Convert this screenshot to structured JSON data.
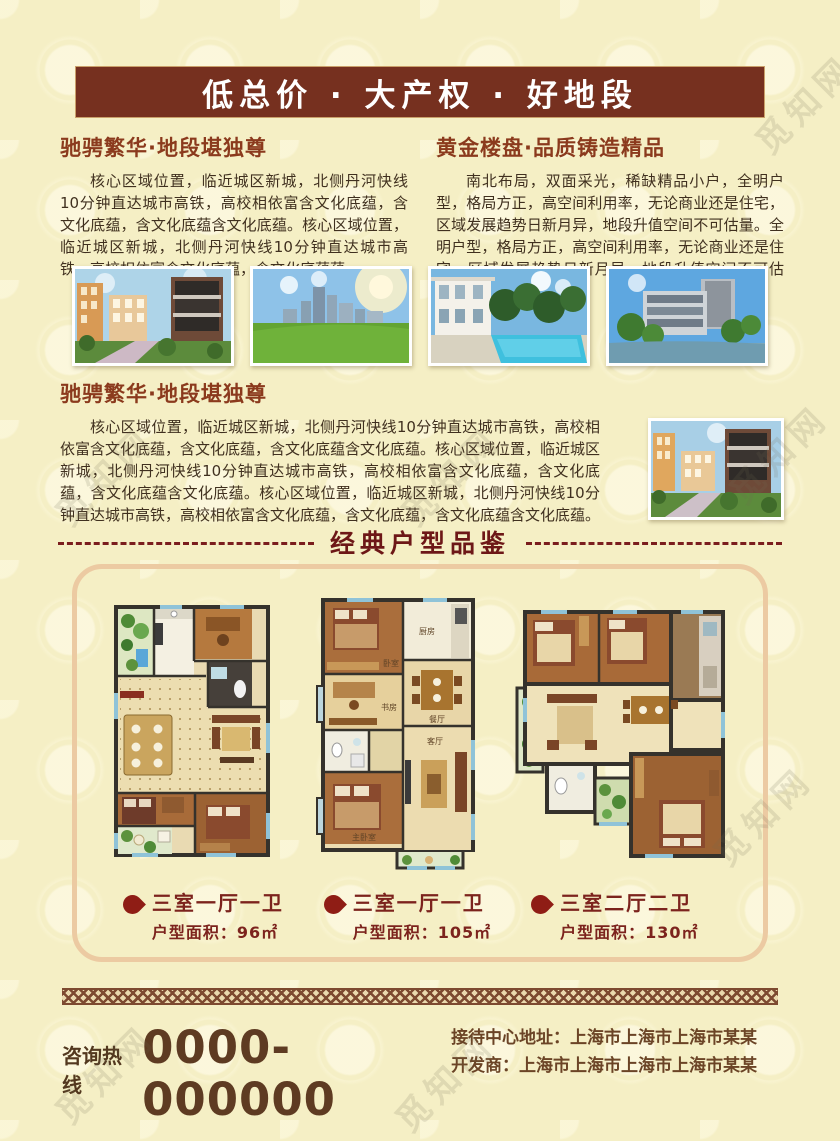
{
  "banner": {
    "title": "低总价 · 大产权 · 好地段"
  },
  "intro_left": {
    "heading": "驰骋繁华·地段堪独尊",
    "body": "核心区域位置，临近城区新城，北侧丹河快线10分钟直达城市高铁，高校相依富含文化底蕴，含文化底蕴，含文化底蕴含文化底蕴。核心区域位置，临近城区新城，北侧丹河快线10分钟直达城市高铁，高校相依富含文化底蕴，含文化底蕴蕴。"
  },
  "intro_right": {
    "heading": "黄金楼盘·品质铸造精品",
    "body": "南北布局，双面采光，稀缺精品小户，全明户型，格局方正，高空间利用率，无论商业还是住宅，区域发展趋势日新月异，地段升值空间不可估量。全明户型，格局方正，高空间利用率，无论商业还是住宅，区域发展趋势日新月异，地段升值空间不可估量。"
  },
  "photos": [
    {
      "name": "residential-courtyard-photo"
    },
    {
      "name": "city-skyline-lawn-photo"
    },
    {
      "name": "villa-pool-photo"
    },
    {
      "name": "office-waterfront-photo"
    }
  ],
  "section2": {
    "heading": "驰骋繁华·地段堪独尊",
    "body": "核心区域位置，临近城区新城，北侧丹河快线10分钟直达城市高铁，高校相依富含文化底蕴，含文化底蕴，含文化底蕴含文化底蕴。核心区域位置，临近城区新城，北侧丹河快线10分钟直达城市高铁，高校相依富含文化底蕴，含文化底蕴，含文化底蕴含文化底蕴。核心区域位置，临近城区新城，北侧丹河快线10分钟直达城市高铁，高校相依富含文化底蕴，含文化底蕴，含文化底蕴含文化底蕴。",
    "photo": "residential-courtyard-photo-2"
  },
  "divider": {
    "title": "经典户型品鉴"
  },
  "floor_plans": [
    {
      "type": "三室一厅一卫",
      "area": "户型面积：96㎡"
    },
    {
      "type": "三室一厅一卫",
      "area": "户型面积：105㎡"
    },
    {
      "type": "三室二厅二卫",
      "area": "户型面积：130㎡"
    }
  ],
  "plan2_rooms": {
    "bedroom": "卧室",
    "kitchen": "厨房",
    "dining": "餐厅",
    "study": "书房",
    "living": "客厅",
    "master": "主卧室"
  },
  "footer": {
    "hotline_label": "咨询热线",
    "hotline_number": "0000-000000",
    "address": "接待中心地址：上海市上海市上海市某某",
    "developer": "开发商：上海市上海市上海市上海市某某"
  },
  "watermark": "觅知网",
  "colors": {
    "banner_bg": "#76301f",
    "heading": "#8b3a1d",
    "divider_text": "#6d1717",
    "label_red": "#7c231d",
    "body_text": "#40301f",
    "box_border": "#eccaa2",
    "accent_dark_red": "#8f1d15"
  }
}
